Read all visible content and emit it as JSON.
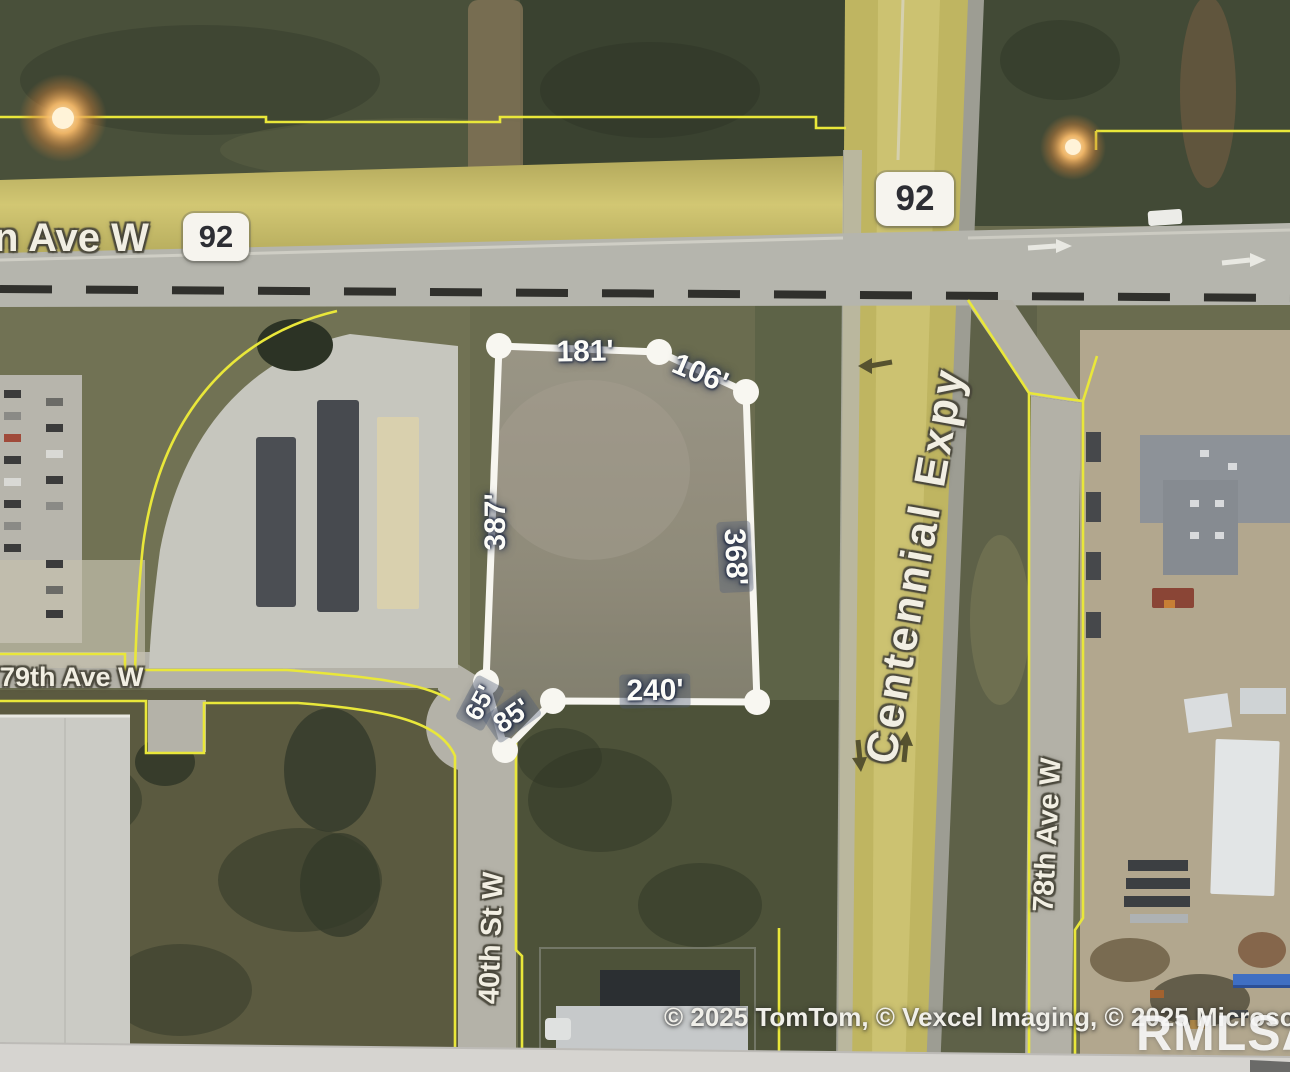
{
  "map": {
    "streets": {
      "ave_w": "n Ave W",
      "route_92": "92",
      "centennial_expy": "Centennial Expy",
      "ave_79": "79th Ave W",
      "st_40": "40th St W",
      "ave_78": "78th Ave W"
    },
    "parcel_dimensions": {
      "top": "181'",
      "top_right": "106'",
      "left": "387'",
      "right": "368'",
      "bottom": "240'",
      "notch_upper": "65'",
      "notch_lower": "85'"
    },
    "attribution": "© 2025 TomTom, © Vexcel Imaging, © 2025 Microsoft Corpor",
    "watermark": "RMLSA",
    "colors": {
      "parcel_outline": "#f7f6f0",
      "boundary_yellow": "#e9e73a",
      "road_tan": "#c0b561",
      "road_gray": "#b5b5ad",
      "glow_orange": "#f5b969"
    }
  }
}
